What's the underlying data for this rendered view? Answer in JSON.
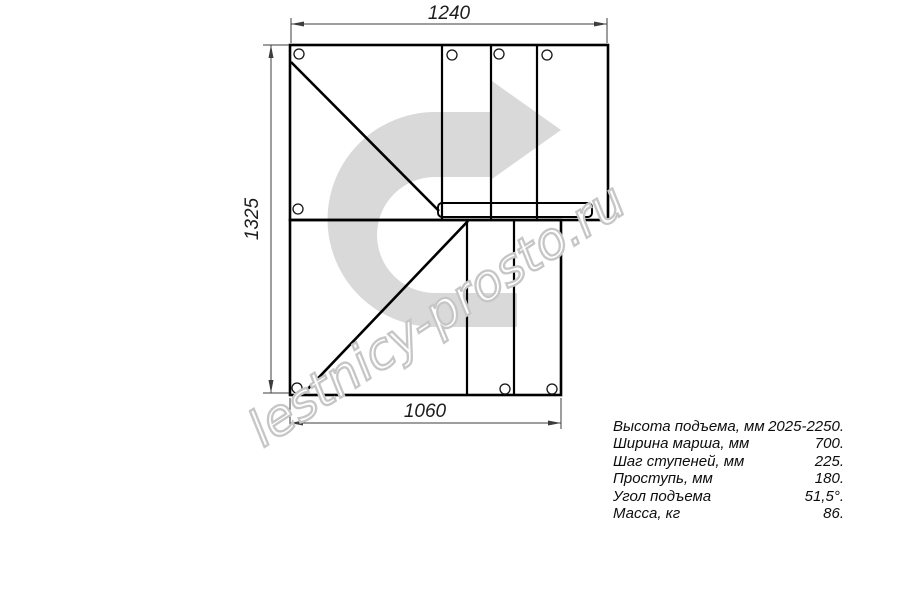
{
  "drawing": {
    "type": "staircase-plan-quarter-turn",
    "line_color": "#000000",
    "background": "#ffffff"
  },
  "dimensions": {
    "top_width_mm": "1240",
    "left_height_mm": "1325",
    "bottom_width_mm": "1060"
  },
  "watermark": {
    "text": "lestnicy-prosto.ru",
    "arrow_color": "#d9d9d9",
    "text_outline_color": "#c6c6c6",
    "text_fill_color": "#ffffff"
  },
  "specs": {
    "rows": [
      {
        "label": "Высота подъема, мм",
        "value": "2025-2250."
      },
      {
        "label": "Ширина марша, мм",
        "value": "700."
      },
      {
        "label": "Шаг ступеней, мм",
        "value": "225."
      },
      {
        "label": "Проступь, мм",
        "value": "180."
      },
      {
        "label": "Угол подъема",
        "value": "51,5°."
      },
      {
        "label": "Масса, кг",
        "value": "86."
      }
    ]
  }
}
